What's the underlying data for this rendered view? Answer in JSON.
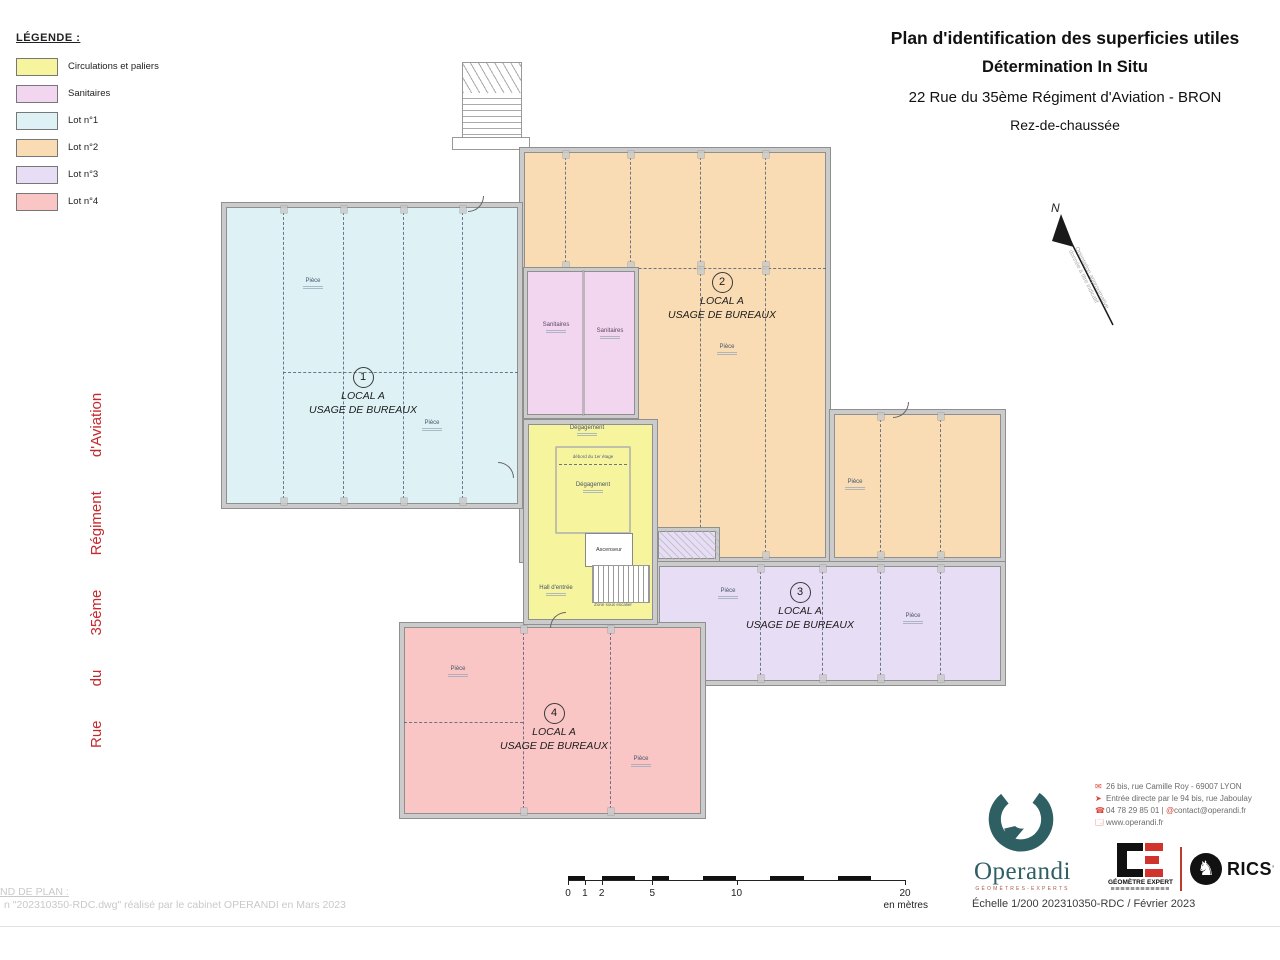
{
  "legend": {
    "title": "LÉGENDE :",
    "items": [
      {
        "label": "Circulations et paliers",
        "color": "#f7f49e"
      },
      {
        "label": "Sanitaires",
        "color": "#f2d5ee"
      },
      {
        "label": "Lot n°1",
        "color": "#def2f6"
      },
      {
        "label": "Lot n°2",
        "color": "#f9dcb3"
      },
      {
        "label": "Lot n°3",
        "color": "#e7ddf5"
      },
      {
        "label": "Lot n°4",
        "color": "#f9c6c5"
      }
    ]
  },
  "title_block": {
    "line1": "Plan d'identification des superficies utiles",
    "line2": "Détermination In Situ",
    "line3": "22 Rue du 35ème Régiment d'Aviation - BRON",
    "line4": "Rez-de-chaussée"
  },
  "street_label": "Rue du 35ème Régiment d'Aviation",
  "north": {
    "letter": "N",
    "note1": "Orientation approximative",
    "note2": "donnée à titre indicatif"
  },
  "zones": {
    "zone1": {
      "number": "1",
      "line1": "LOCAL A",
      "line2": "USAGE DE BUREAUX"
    },
    "zone2": {
      "number": "2",
      "line1": "LOCAL A",
      "line2": "USAGE DE BUREAUX"
    },
    "zone3": {
      "number": "3",
      "line1": "LOCAL A",
      "line2": "USAGE DE BUREAUX"
    },
    "zone4": {
      "number": "4",
      "line1": "LOCAL A",
      "line2": "USAGE DE BUREAUX"
    }
  },
  "rooms": {
    "piece": "Pièce",
    "sanitaires": "Sanitaires",
    "degagement": "Dégagement",
    "debord": "débord du 1er étage",
    "ascenseur": "Ascenseur",
    "hall": "Hall d'entrée",
    "zone_sous_escalier": "Zone sous escalier"
  },
  "scalebar": {
    "ticks": [
      "0",
      "1",
      "2",
      "5",
      "10",
      "20"
    ],
    "unit": "en mètres"
  },
  "plan_footer": {
    "line1": "ND DE PLAN :",
    "line2": "n \"202310350-RDC.dwg\" réalisé par le cabinet OPERANDI en Mars 2023"
  },
  "company": {
    "name": "Operandi",
    "tagline": "GÉOMÈTRES-EXPERTS",
    "address": "26 bis, rue Camille Roy - 69007 LYON",
    "entrance": "Entrée directe par le 94 bis, rue Jaboulay",
    "phone": "04 78 29 85 01",
    "separator": "|",
    "at": "@",
    "email": "contact@operandi.fr",
    "website": "www.operandi.fr",
    "ge_label": "GÉOMÈTRE EXPERT",
    "rics_label": "RICS",
    "rics_suffix": "’",
    "scale_ref": "Échelle 1/200 202310350-RDC / Février 2023"
  },
  "colors": {
    "street_text": "#c5292d",
    "walls": "#cbcbcb",
    "brand_teal": "#2d5f63",
    "lot1": "#def2f6",
    "lot2": "#f9dcb3",
    "lot3": "#e7ddf5",
    "lot4": "#f9c6c5",
    "circulations": "#f7f49e",
    "sanitaires": "#f2d5ee"
  }
}
